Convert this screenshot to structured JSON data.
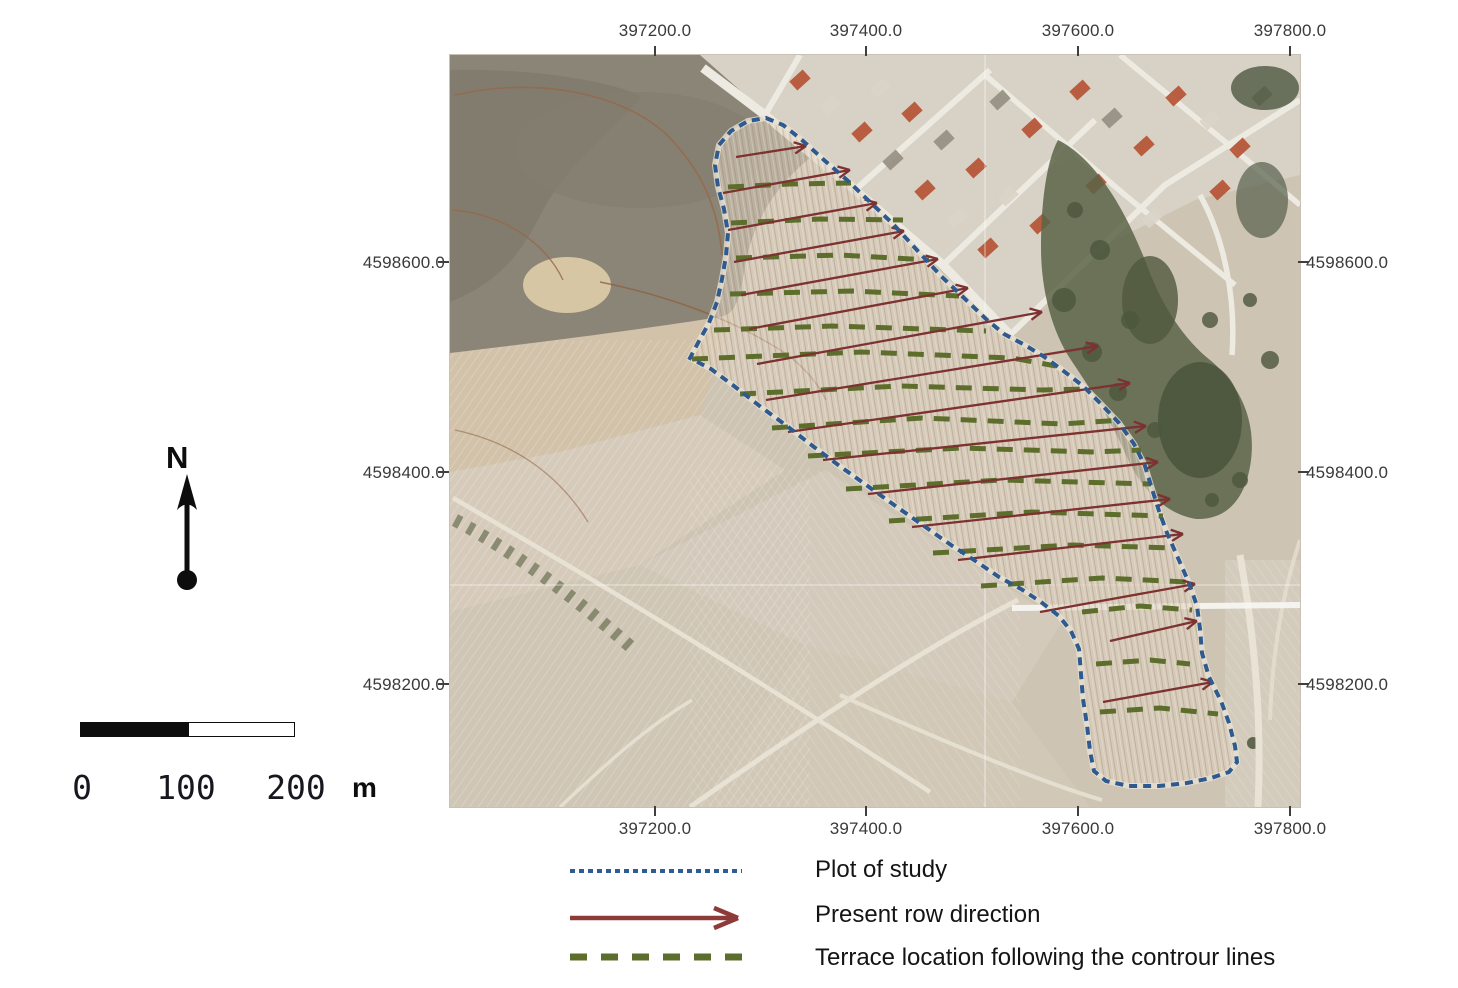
{
  "figure": {
    "kind": "aerial-map-figure"
  },
  "axes": {
    "x_labels": [
      "397200.0",
      "397400.0",
      "397600.0",
      "397800.0"
    ],
    "y_labels": [
      "4598600.0",
      "4598400.0",
      "4598200.0"
    ]
  },
  "north_arrow": {
    "label": "N"
  },
  "scale_bar": {
    "tick_labels": [
      "0",
      "100",
      "200"
    ],
    "unit_label": "m"
  },
  "legend": {
    "items": [
      {
        "id": "plot-of-study",
        "label": "Plot of study",
        "color": "#2f5c94",
        "style": "dashed-fine"
      },
      {
        "id": "present-row-direction",
        "label": "Present row direction",
        "color": "#8c3b39",
        "style": "arrow"
      },
      {
        "id": "terrace-location",
        "label": "Terrace location following the controur lines",
        "color": "#5d6e2c",
        "style": "dashed-long"
      }
    ]
  },
  "map_data": {
    "colors": {
      "plot_outline": "#2e5a8f",
      "row_arrow": "#7d3231",
      "terrace": "#5d6e2c"
    },
    "plot_polygon": [
      [
        766,
        118
      ],
      [
        783,
        125
      ],
      [
        802,
        140
      ],
      [
        824,
        160
      ],
      [
        847,
        180
      ],
      [
        870,
        202
      ],
      [
        893,
        224
      ],
      [
        916,
        249
      ],
      [
        941,
        276
      ],
      [
        963,
        297
      ],
      [
        986,
        319
      ],
      [
        1004,
        334
      ],
      [
        1023,
        344
      ],
      [
        1043,
        356
      ],
      [
        1061,
        369
      ],
      [
        1083,
        386
      ],
      [
        1101,
        404
      ],
      [
        1119,
        423
      ],
      [
        1134,
        444
      ],
      [
        1145,
        466
      ],
      [
        1152,
        489
      ],
      [
        1159,
        511
      ],
      [
        1167,
        533
      ],
      [
        1178,
        558
      ],
      [
        1189,
        583
      ],
      [
        1197,
        606
      ],
      [
        1200,
        629
      ],
      [
        1202,
        653
      ],
      [
        1209,
        677
      ],
      [
        1221,
        701
      ],
      [
        1229,
        723
      ],
      [
        1235,
        746
      ],
      [
        1237,
        762
      ],
      [
        1229,
        772
      ],
      [
        1211,
        778
      ],
      [
        1187,
        783
      ],
      [
        1159,
        786
      ],
      [
        1129,
        786
      ],
      [
        1106,
        781
      ],
      [
        1094,
        771
      ],
      [
        1090,
        751
      ],
      [
        1087,
        725
      ],
      [
        1083,
        699
      ],
      [
        1081,
        674
      ],
      [
        1079,
        649
      ],
      [
        1071,
        631
      ],
      [
        1059,
        616
      ],
      [
        1041,
        602
      ],
      [
        1021,
        589
      ],
      [
        999,
        577
      ],
      [
        977,
        562
      ],
      [
        951,
        545
      ],
      [
        924,
        526
      ],
      [
        897,
        507
      ],
      [
        869,
        487
      ],
      [
        841,
        467
      ],
      [
        814,
        447
      ],
      [
        787,
        426
      ],
      [
        761,
        407
      ],
      [
        734,
        386
      ],
      [
        711,
        369
      ],
      [
        690,
        358
      ],
      [
        699,
        341
      ],
      [
        709,
        323
      ],
      [
        717,
        302
      ],
      [
        722,
        279
      ],
      [
        726,
        256
      ],
      [
        728,
        233
      ],
      [
        724,
        209
      ],
      [
        718,
        187
      ],
      [
        715,
        165
      ],
      [
        719,
        145
      ],
      [
        731,
        131
      ],
      [
        748,
        121
      ]
    ],
    "row_arrows": [
      [
        736,
        157,
        806,
        146
      ],
      [
        723,
        193,
        850,
        170
      ],
      [
        728,
        230,
        877,
        203
      ],
      [
        734,
        262,
        904,
        231
      ],
      [
        741,
        295,
        938,
        259
      ],
      [
        749,
        329,
        968,
        288
      ],
      [
        757,
        364,
        1042,
        312
      ],
      [
        766,
        400,
        1098,
        346
      ],
      [
        788,
        432,
        1130,
        383
      ],
      [
        823,
        460,
        1146,
        426
      ],
      [
        868,
        494,
        1158,
        462
      ],
      [
        912,
        527,
        1170,
        499
      ],
      [
        958,
        560,
        1183,
        534
      ],
      [
        1040,
        612,
        1195,
        584
      ],
      [
        1110,
        641,
        1197,
        621
      ],
      [
        1103,
        702,
        1213,
        682
      ]
    ],
    "terrace_lines": [
      [
        [
          728,
          187
        ],
        [
          790,
          184
        ],
        [
          851,
          183
        ]
      ],
      [
        [
          731,
          223
        ],
        [
          820,
          219
        ],
        [
          903,
          220
        ]
      ],
      [
        [
          736,
          258
        ],
        [
          840,
          255
        ],
        [
          929,
          260
        ]
      ],
      [
        [
          730,
          294
        ],
        [
          852,
          291
        ],
        [
          959,
          296
        ]
      ],
      [
        [
          714,
          330
        ],
        [
          832,
          326
        ],
        [
          986,
          331
        ]
      ],
      [
        [
          692,
          359
        ],
        [
          862,
          352
        ],
        [
          1012,
          358
        ],
        [
          1056,
          366
        ]
      ],
      [
        [
          740,
          394
        ],
        [
          900,
          386
        ],
        [
          1042,
          390
        ],
        [
          1091,
          389
        ]
      ],
      [
        [
          772,
          428
        ],
        [
          922,
          418
        ],
        [
          1062,
          424
        ],
        [
          1122,
          420
        ]
      ],
      [
        [
          808,
          456
        ],
        [
          962,
          448
        ],
        [
          1092,
          452
        ],
        [
          1141,
          450
        ]
      ],
      [
        [
          846,
          489
        ],
        [
          1002,
          480
        ],
        [
          1151,
          484
        ]
      ],
      [
        [
          889,
          521
        ],
        [
          1032,
          512
        ],
        [
          1163,
          516
        ]
      ],
      [
        [
          933,
          553
        ],
        [
          1072,
          545
        ],
        [
          1174,
          548
        ]
      ],
      [
        [
          981,
          586
        ],
        [
          1102,
          578
        ],
        [
          1187,
          582
        ]
      ],
      [
        [
          1082,
          612
        ],
        [
          1140,
          606
        ],
        [
          1192,
          610
        ]
      ],
      [
        [
          1096,
          664
        ],
        [
          1150,
          660
        ],
        [
          1190,
          664
        ]
      ],
      [
        [
          1100,
          712
        ],
        [
          1160,
          708
        ],
        [
          1218,
          714
        ]
      ]
    ]
  }
}
